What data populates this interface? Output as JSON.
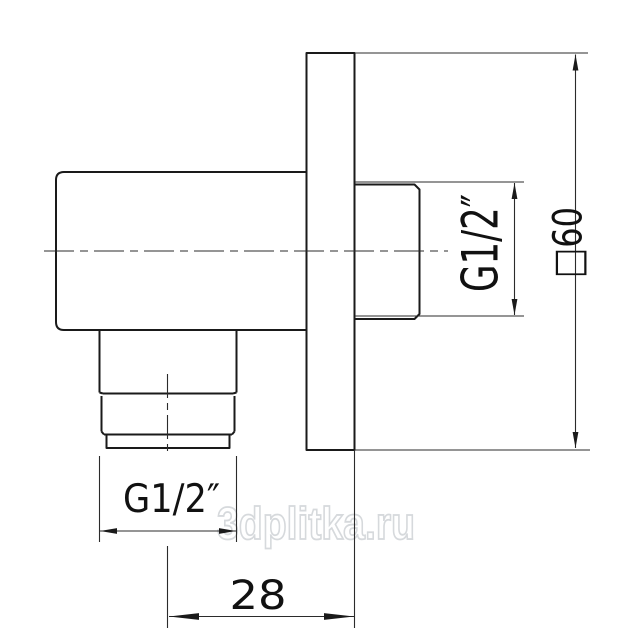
{
  "drawing": {
    "type": "technical-dimension-drawing",
    "background": "#ffffff",
    "line_color": "#1a1a1a",
    "labels": {
      "side_thread": "G1/2″",
      "plate_size": "□60",
      "bottom_thread": "G1/2″",
      "wall_offset": "28"
    },
    "watermark": {
      "text": "3dplitka.ru",
      "color": "#d6d9dc"
    }
  }
}
